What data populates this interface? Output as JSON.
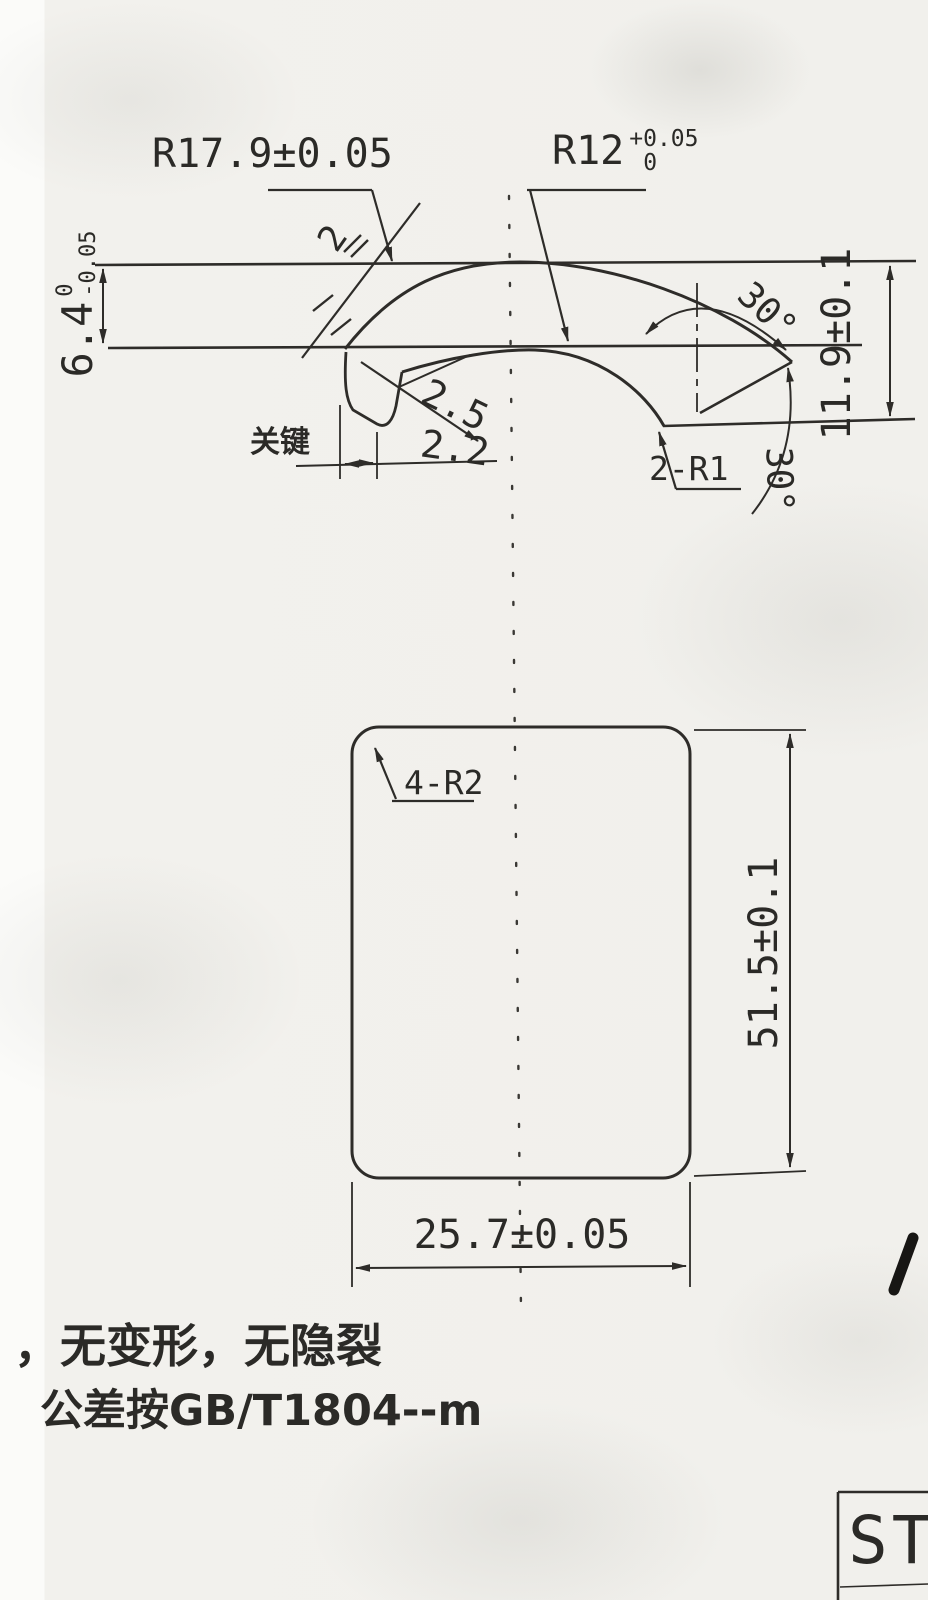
{
  "colors": {
    "ink": "#2e2c29",
    "paper": "#f1f0ec"
  },
  "profile_view": {
    "outer_radius_label": "R17.9±0.05",
    "inner_radius_value": "R12",
    "inner_radius_tol_upper": "+0.05",
    "inner_radius_tol_lower": "0",
    "thickness_value": "6.4",
    "thickness_tol_upper": "0",
    "thickness_tol_lower": "-0.05",
    "overall_height_label": "11.9±0.1",
    "key_note": "关键",
    "slot_width_label": "2",
    "slot_depth_label": "2.5",
    "slot_opening_label": "2.2",
    "tip_angle_upper_label": "30°",
    "tip_angle_lower_label": "30°",
    "tip_radii_label": "2-R1"
  },
  "plan_view": {
    "corner_radii_label": "4-R2",
    "length_label": "51.5±0.1",
    "width_label": "25.7±0.05"
  },
  "notes": {
    "line1": "，无变形，无隐裂",
    "line2": "公差按GB/T1804--m"
  },
  "title_block": {
    "visible_text": "ST"
  },
  "annotations": {
    "handwritten_mark": "1"
  }
}
